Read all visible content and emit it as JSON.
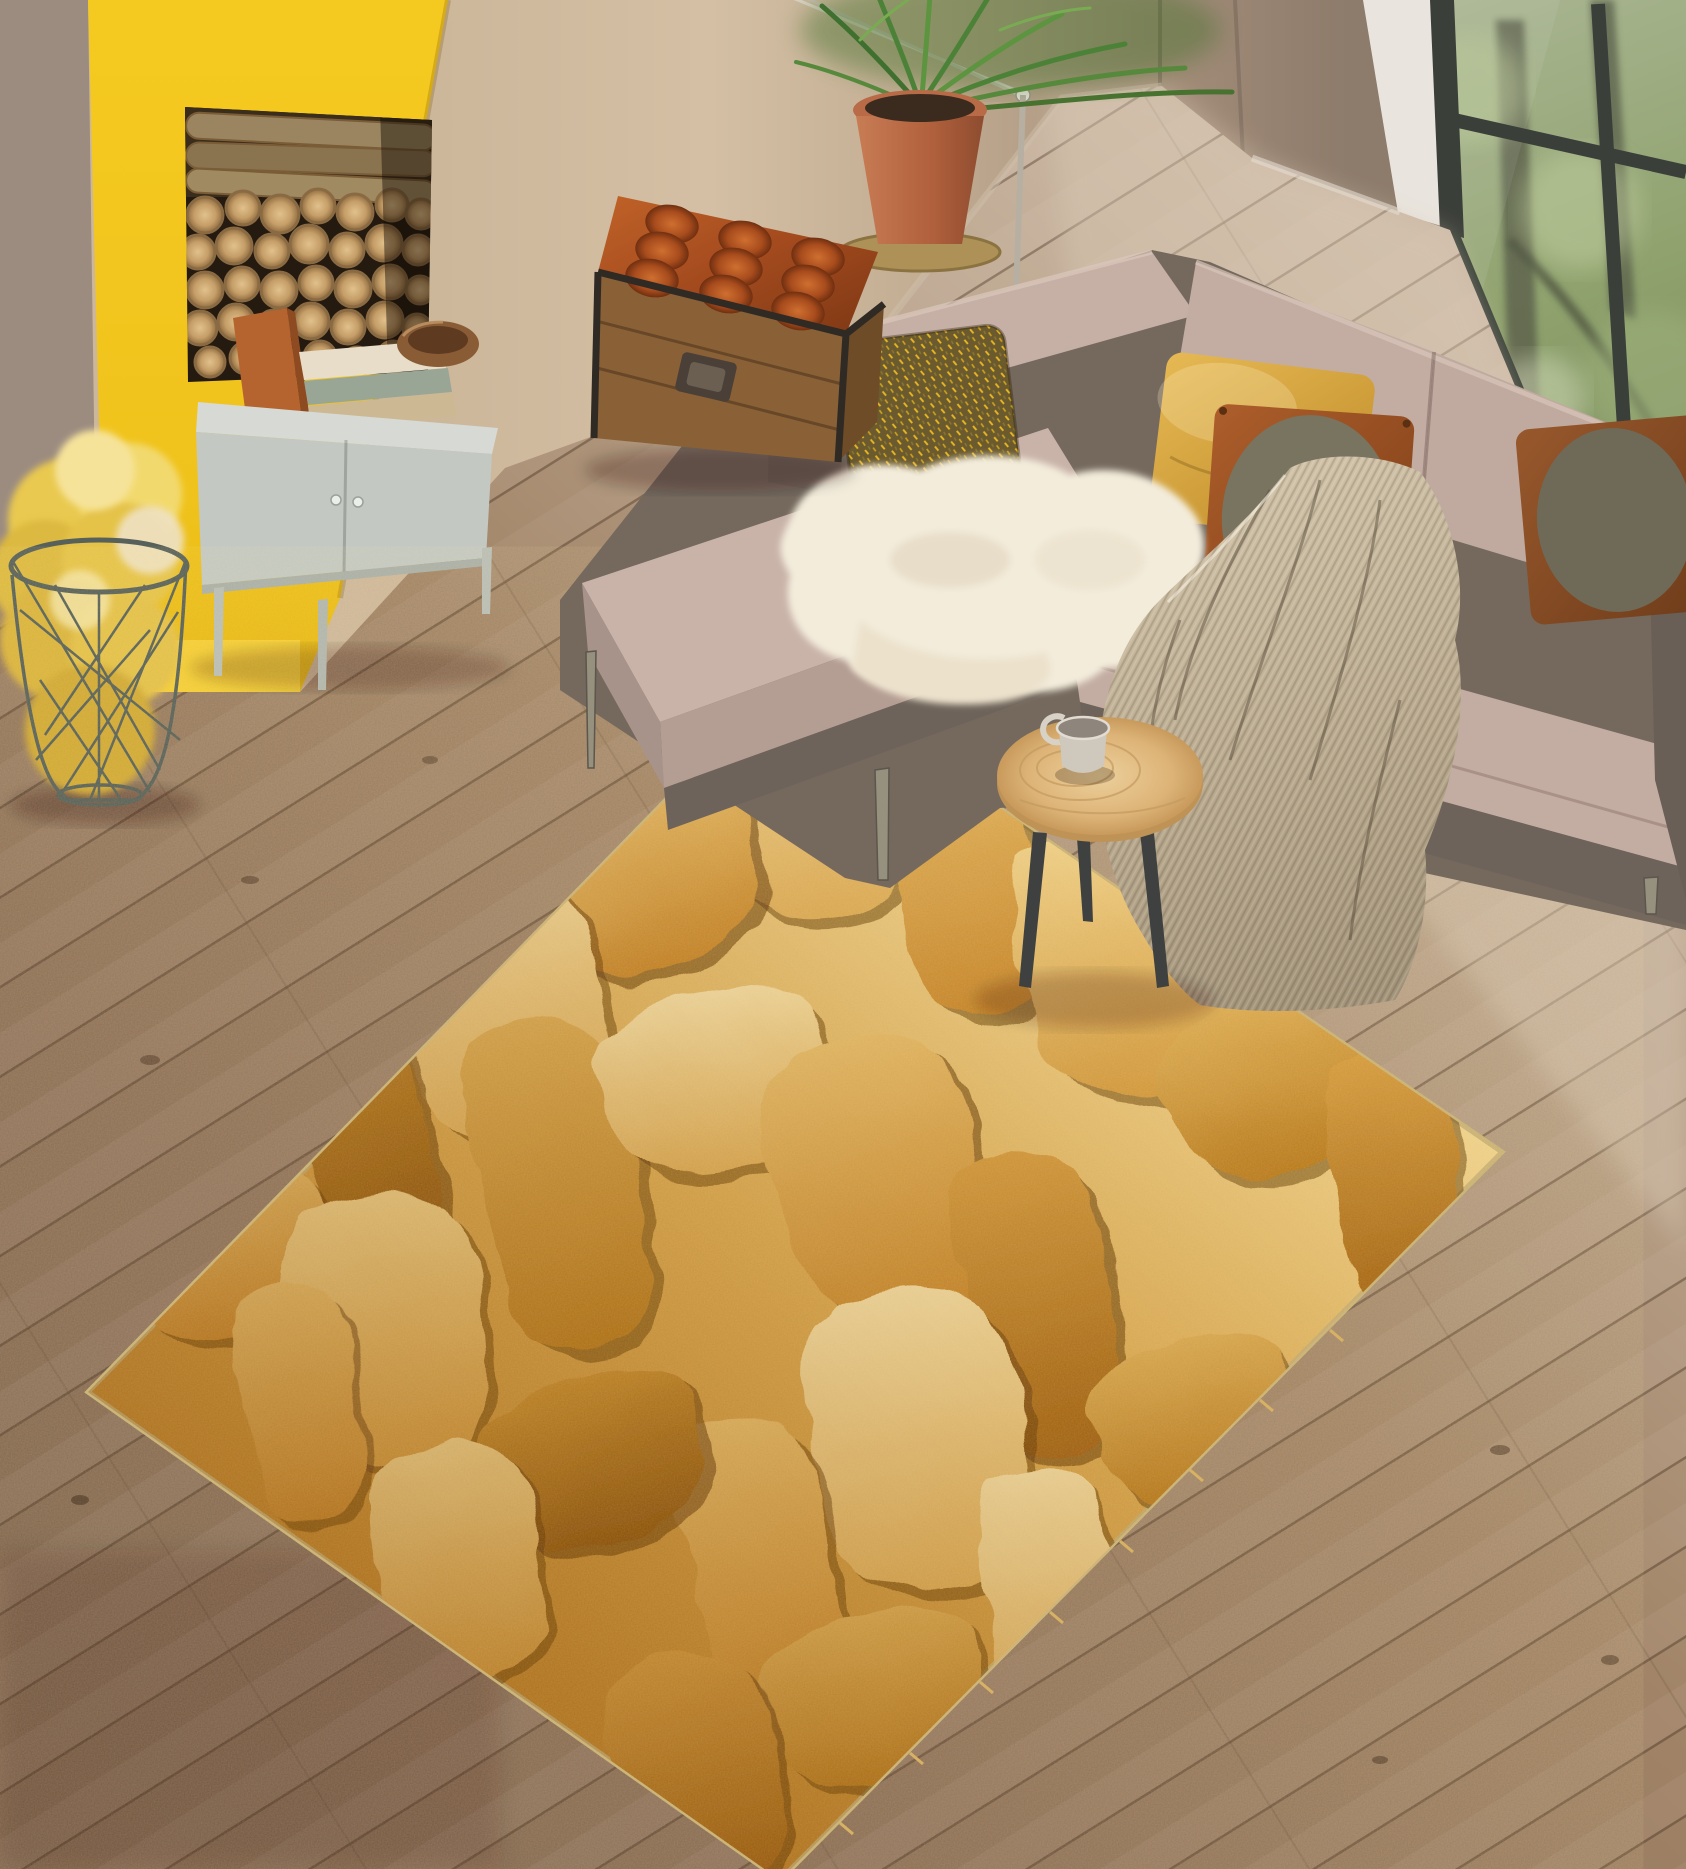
{
  "scene": {
    "type": "living-room-photo",
    "description": "Top-down view of a living room: yellow fireplace column with firewood niche, grey metal cabinet with books and wooden bowl, wire basket with yellow wool throw, leather-topped wooden trunk, taupe corner sectional sofa with mustard, gold-flecked and leather pillows, white sheepskin, ribbed beige throw, round wooden tripod side table with a grey cup, potted palm in terracotta pot, floor lamp, black-framed window onto green forest, wood plank floor, and a large gold paint-smear textured rug.",
    "labels": {
      "room": "living room scene",
      "wall_left": "dark taupe wall strip",
      "fireplace": "yellow fireplace column",
      "niche": "firewood storage niche with stacked logs",
      "cabinet": "grey metal storage cabinet",
      "books": "books stacked on cabinet",
      "bowl": "wooden bowl",
      "basket": "wire basket with yellow wool blanket",
      "trunk": "wooden trunk with tufted leather top",
      "sofa": "taupe corner sectional sofa",
      "pillow_gold": "gold flecked accent pillow",
      "pillow_mustard": "mustard yellow pillow",
      "pillow_leather_left": "leather pillow with olive circle",
      "pillow_leather_right": "leather pillow with olive circle (right)",
      "sheepskin": "white sheepskin throw",
      "blanket": "ribbed beige throw blanket",
      "lamp": "metal floor lamp arm",
      "plant": "potted palm in terracotta pot",
      "table": "round wooden tripod side table",
      "cup": "grey ceramic cup",
      "window": "black framed window with forest view",
      "floor": "wood plank floor",
      "rug": "gold paint-smear textured rug"
    },
    "palette": {
      "fireplace_yellow": "#f3c81f",
      "wall_beige": "#cdb79b",
      "wall_taupe": "#8d7b6b",
      "corner_strip_white": "#e9e5de",
      "floor_brown": "#8d7059",
      "floor_light": "#cdbba7",
      "cabinet_grey": "#c3c8c2",
      "basket_wire": "#57605a",
      "blanket_yellow": "#e5c34a",
      "trunk_leather": "#a34a1e",
      "trunk_wood": "#8a6137",
      "sofa_fabric": "#c3ada3",
      "sofa_base": "#75695e",
      "pillow_mustard": "#d7a63f",
      "pillow_leather": "#9d5a2e",
      "pillow_olive": "#77725f",
      "sheepskin_white": "#f3ecdb",
      "throw_beige": "#b3a58c",
      "table_ash": "#ddb377",
      "cup_grey": "#cfc8bd",
      "window_frame": "#3b3f3a",
      "forest_green": "#8fa26d",
      "rug_gold_light": "#f0d695",
      "rug_gold_mid": "#d99b3f",
      "rug_gold_deep": "#a36312",
      "rug_crevice": "#5e350a"
    },
    "objects": [
      {
        "id": "fireplace-column",
        "label": "yellow fireplace column with firewood niche"
      },
      {
        "id": "log-stack",
        "label": "stacked cut firewood logs"
      },
      {
        "id": "storage-cabinet",
        "label": "grey cabinet with books and wooden bowl"
      },
      {
        "id": "wire-basket",
        "label": "wire basket holding yellow wool blanket"
      },
      {
        "id": "leather-trunk",
        "label": "trunk with tufted leather cushion top"
      },
      {
        "id": "sectional-sofa",
        "label": "corner sectional sofa with pillows"
      },
      {
        "id": "side-table",
        "label": "round tripod table with cup"
      },
      {
        "id": "potted-palm",
        "label": "palm plant in terracotta pot"
      },
      {
        "id": "window-forest",
        "label": "window with green forest view"
      },
      {
        "id": "gold-rug",
        "label": "gold textured area rug"
      }
    ]
  }
}
